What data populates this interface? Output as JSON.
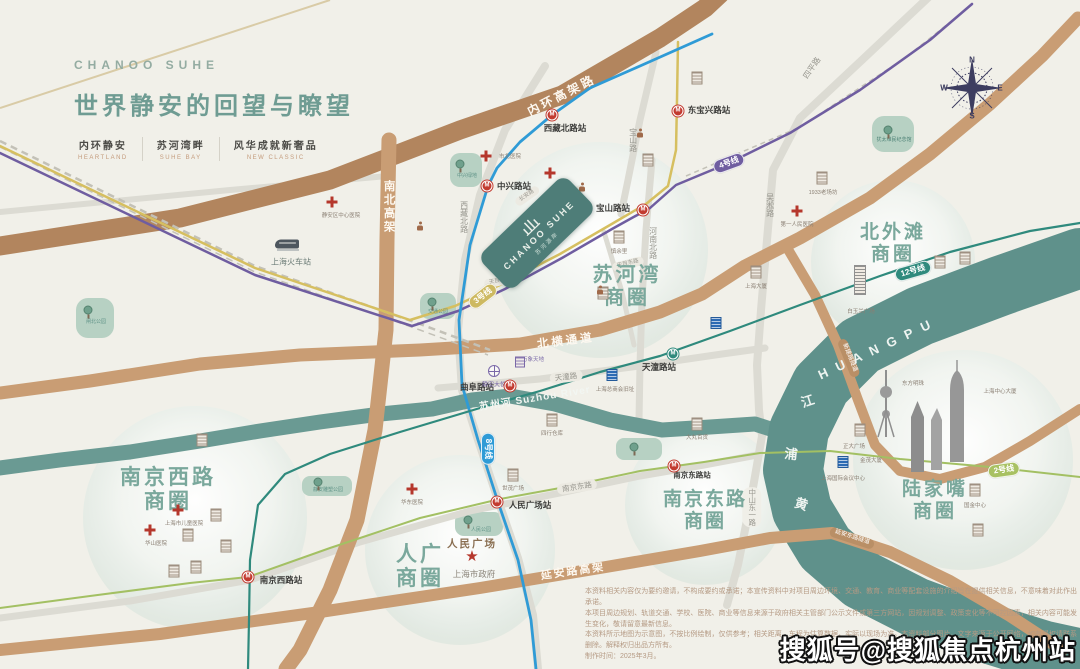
{
  "header": {
    "brand": "CHANOO SUHE",
    "title": "世界静安的回望与瞭望",
    "taglines": [
      {
        "zh": "内环静安",
        "en": "HEARTLAND"
      },
      {
        "zh": "苏河湾畔",
        "en": "SUHE BAY"
      },
      {
        "zh": "风华成就新奢品",
        "en": "NEW CLASSIC"
      }
    ]
  },
  "project": {
    "logo_en": "CHANOO SUHE",
    "logo_zh": "苏河源岸"
  },
  "watermark": "搜狐号@搜狐焦点杭州站",
  "disclaimer": {
    "lines": [
      "本资料相关内容仅为要约邀请，不构成要约或承诺；本宣传资料中对项目周边环境、交通、教育、商业等配套设施的介绍旨在提供相关信息，不意味着对此作出承诺。",
      "本项目周边规划、轨道交通、学校、医院、商业等信息来源于政府相关主管部门公示文件或第三方网站，因规划调整、政策变化等不可控因素，相关内容可能发生变化，敬请留意最新信息。",
      "本资料所示地图为示意图，不按比例绘制，仅供参考；相关距离、车程为估算数据，实际以现场为准。本资料部分图片、文字来源于公开网络，如有侵权请联系删除。解释权归出品方所有。",
      "制作时间：2025年3月。"
    ]
  },
  "map": {
    "labels": [
      {
        "t": "内环高架路",
        "x": 562,
        "y": 96,
        "fs": 12,
        "c": "#fdf8f0",
        "b": 1,
        "r": -27,
        "ls": 3,
        "cls": "road-name"
      },
      {
        "t": "南北高架",
        "x": 388,
        "y": 207,
        "fs": 11.5,
        "c": "#fdf8f0",
        "b": 1,
        "v": 1,
        "ls": 2,
        "cls": "road-name"
      },
      {
        "t": "北横通道",
        "x": 566,
        "y": 342,
        "fs": 11.5,
        "c": "#fdf8f0",
        "b": 1,
        "r": -7,
        "ls": 3,
        "cls": "road-name"
      },
      {
        "t": "延安路高架",
        "x": 573,
        "y": 572,
        "fs": 11,
        "c": "#fdf8f0",
        "b": 1,
        "r": -8,
        "ls": 2,
        "cls": "road-name"
      },
      {
        "t": "延安东路隧道",
        "x": 852,
        "y": 538,
        "fs": 6,
        "c": "#ffffff",
        "r": 18,
        "bg": "#b98f66",
        "cls": "tunnel-name"
      },
      {
        "t": "新建路隧道",
        "x": 849,
        "y": 358,
        "fs": 6,
        "c": "#ffffff",
        "r": 68,
        "bg": "#b98f66",
        "cls": "tunnel-name"
      },
      {
        "t": "四平路",
        "x": 812,
        "y": 68,
        "fs": 8,
        "c": "#97968e",
        "r": -55,
        "cls": "street-name"
      },
      {
        "t": "吴淞路",
        "x": 770,
        "y": 205,
        "fs": 8,
        "c": "#97968e",
        "v": 1,
        "cls": "street-name"
      },
      {
        "t": "宝山路",
        "x": 633,
        "y": 140,
        "fs": 8,
        "c": "#97968e",
        "v": 1,
        "cls": "street-name"
      },
      {
        "t": "西藏北路",
        "x": 464,
        "y": 217,
        "fs": 8,
        "c": "#97968e",
        "v": 1,
        "cls": "street-name"
      },
      {
        "t": "河南北路",
        "x": 653,
        "y": 243,
        "fs": 8,
        "c": "#97968e",
        "v": 1,
        "cls": "street-name"
      },
      {
        "t": "中山东一路",
        "x": 752,
        "y": 507,
        "fs": 7.5,
        "c": "#97968e",
        "v": 1,
        "bg": "#f0efe8",
        "cls": "street-name"
      },
      {
        "t": "天潼路",
        "x": 566,
        "y": 377,
        "fs": 7.5,
        "c": "#97968e",
        "r": -7,
        "bg": "#eceae2",
        "cls": "street-name"
      },
      {
        "t": "南京东路",
        "x": 577,
        "y": 487,
        "fs": 7.5,
        "c": "#97968e",
        "r": -9,
        "bg": "#eceae2",
        "cls": "street-name"
      },
      {
        "t": "长安路",
        "x": 527,
        "y": 196,
        "fs": 5.5,
        "c": "#9b9a92",
        "r": -35,
        "bg": "#eceae2",
        "cls": "street-name"
      },
      {
        "t": "公兴路",
        "x": 572,
        "y": 195,
        "fs": 5.5,
        "c": "#9b9a92",
        "r": -35,
        "bg": "#eceae2",
        "cls": "street-name"
      },
      {
        "t": "天目中路",
        "x": 500,
        "y": 281,
        "fs": 5.5,
        "c": "#9b9a92",
        "r": -12,
        "bg": "#eceae2",
        "cls": "street-name"
      },
      {
        "t": "天目东路",
        "x": 628,
        "y": 264,
        "fs": 5.5,
        "c": "#9b9a92",
        "r": -14,
        "bg": "#eceae2",
        "cls": "street-name"
      },
      {
        "t": "3号线",
        "x": 483,
        "y": 296,
        "fs": 8,
        "c": "#ffffff",
        "b": 1,
        "r": -38,
        "bg": "#cdb961",
        "cls": "metro-badge"
      },
      {
        "t": "4号线",
        "x": 729,
        "y": 163,
        "fs": 8,
        "c": "#ffffff",
        "b": 1,
        "r": -20,
        "bg": "#6f5da0",
        "cls": "metro-badge"
      },
      {
        "t": "8号线",
        "x": 488,
        "y": 449,
        "fs": 8,
        "c": "#ffffff",
        "b": 1,
        "r": 90,
        "bg": "#2f9bd6",
        "cls": "metro-badge"
      },
      {
        "t": "12号线",
        "x": 913,
        "y": 271,
        "fs": 8,
        "c": "#ffffff",
        "b": 1,
        "r": -16,
        "bg": "#2f8a7d",
        "cls": "metro-badge"
      },
      {
        "t": "2号线",
        "x": 1004,
        "y": 470,
        "fs": 8,
        "c": "#ffffff",
        "b": 1,
        "r": -8,
        "bg": "#a8c162",
        "cls": "metro-badge"
      },
      {
        "t": "中兴路站",
        "x": 514,
        "y": 187,
        "fs": 8.5,
        "c": "#3c3c3a",
        "b": 1,
        "cls": "station-name"
      },
      {
        "t": "西藏北路站",
        "x": 565,
        "y": 129,
        "fs": 8.5,
        "c": "#3c3c3a",
        "b": 1,
        "cls": "station-name"
      },
      {
        "t": "东宝兴路站",
        "x": 709,
        "y": 111,
        "fs": 8.5,
        "c": "#3c3c3a",
        "b": 1,
        "cls": "station-name"
      },
      {
        "t": "宝山路站",
        "x": 613,
        "y": 209,
        "fs": 8.5,
        "c": "#3c3c3a",
        "b": 1,
        "cls": "station-name"
      },
      {
        "t": "天潼路站",
        "x": 659,
        "y": 368,
        "fs": 8.5,
        "c": "#3c3c3a",
        "b": 1,
        "cls": "station-name"
      },
      {
        "t": "曲阜路站",
        "x": 477,
        "y": 388,
        "fs": 8.5,
        "c": "#3c3c3a",
        "b": 1,
        "cls": "station-name"
      },
      {
        "t": "人民广场站",
        "x": 530,
        "y": 506,
        "fs": 8.5,
        "c": "#3c3c3a",
        "b": 1,
        "cls": "station-name"
      },
      {
        "t": "南京东路站",
        "x": 692,
        "y": 476,
        "fs": 7.5,
        "c": "#3c3c3a",
        "b": 1,
        "cls": "station-name"
      },
      {
        "t": "南京西路站",
        "x": 281,
        "y": 581,
        "fs": 8.5,
        "c": "#3c3c3a",
        "b": 1,
        "cls": "station-name"
      },
      {
        "t": "苏河湾\n商圈",
        "x": 627,
        "y": 287,
        "fs": 20,
        "c": "#7aa89c",
        "b": 1,
        "ls": 3,
        "cls": "district-name"
      },
      {
        "t": "北外滩\n商圈",
        "x": 893,
        "y": 244,
        "fs": 19,
        "c": "#7aa89c",
        "b": 1,
        "ls": 3,
        "cls": "district-name"
      },
      {
        "t": "南京西路\n商圈",
        "x": 168,
        "y": 490,
        "fs": 21,
        "c": "#7aa89c",
        "b": 1,
        "ls": 3,
        "cls": "district-name"
      },
      {
        "t": "人广\n商圈",
        "x": 420,
        "y": 567,
        "fs": 21,
        "c": "#7aa89c",
        "b": 1,
        "ls": 3,
        "cls": "district-name"
      },
      {
        "t": "南京东路\n商圈",
        "x": 705,
        "y": 511,
        "fs": 19,
        "c": "#7aa89c",
        "b": 1,
        "ls": 2,
        "cls": "district-name"
      },
      {
        "t": "陆家嘴\n商圈",
        "x": 935,
        "y": 501,
        "fs": 19,
        "c": "#7aa89c",
        "b": 1,
        "ls": 3,
        "cls": "district-name"
      },
      {
        "t": "苏州河 Suzhou River",
        "x": 535,
        "y": 399,
        "fs": 10,
        "c": "#f2f6f2",
        "b": 1,
        "r": -9,
        "ls": 1,
        "cls": "river-name"
      },
      {
        "t": "H U A N G   P U",
        "x": 876,
        "y": 350,
        "fs": 13,
        "c": "#eef4f1",
        "b": 1,
        "r": -25,
        "ls": 3,
        "cls": "river-name"
      },
      {
        "t": "江",
        "x": 808,
        "y": 402,
        "fs": 13,
        "c": "#eef4f1",
        "b": 1,
        "r": -18,
        "cls": "river-name"
      },
      {
        "t": "浦",
        "x": 791,
        "y": 455,
        "fs": 13,
        "c": "#eef4f1",
        "b": 1,
        "r": 6,
        "cls": "river-name"
      },
      {
        "t": "黄",
        "x": 801,
        "y": 505,
        "fs": 13,
        "c": "#eef4f1",
        "b": 1,
        "r": 18,
        "cls": "river-name"
      },
      {
        "t": "白玉兰广场",
        "x": 861,
        "y": 312,
        "fs": 5.5,
        "cls": "poi-name"
      },
      {
        "t": "1933老场坊",
        "x": 823,
        "y": 193,
        "fs": 5.5,
        "cls": "poi-name"
      },
      {
        "t": "上海大厦",
        "x": 756,
        "y": 287,
        "fs": 5.5,
        "cls": "poi-name"
      },
      {
        "t": "大丸百货",
        "x": 697,
        "y": 438,
        "fs": 5.5,
        "cls": "poi-name"
      },
      {
        "t": "世茂广场",
        "x": 513,
        "y": 489,
        "fs": 5.5,
        "cls": "poi-name"
      },
      {
        "t": "四行仓库",
        "x": 552,
        "y": 434,
        "fs": 5.5,
        "cls": "poi-name"
      },
      {
        "t": "上海总商会旧址",
        "x": 615,
        "y": 390,
        "fs": 5.5,
        "cls": "poi-name"
      },
      {
        "t": "慎余里",
        "x": 619,
        "y": 252,
        "fs": 5.5,
        "cls": "poi-name"
      },
      {
        "t": "正大广场",
        "x": 854,
        "y": 447,
        "fs": 5.5,
        "cls": "poi-name"
      },
      {
        "t": "国金中心",
        "x": 975,
        "y": 506,
        "fs": 5.5,
        "cls": "poi-name"
      },
      {
        "t": "东方明珠",
        "x": 913,
        "y": 384,
        "fs": 5.5,
        "cls": "poi-name"
      },
      {
        "t": "金茂大厦",
        "x": 871,
        "y": 461,
        "fs": 5.5,
        "cls": "poi-name"
      },
      {
        "t": "上海中心大厦",
        "x": 1000,
        "y": 392,
        "fs": 5.5,
        "cls": "poi-name"
      },
      {
        "t": "上海国际会议中心",
        "x": 843,
        "y": 479,
        "fs": 5.5,
        "cls": "poi-name"
      },
      {
        "t": "静安大悦城",
        "x": 497,
        "y": 386,
        "fs": 6,
        "c": "#7a68a8",
        "cls": "poi-name"
      },
      {
        "t": "万象天地",
        "x": 533,
        "y": 360,
        "fs": 5.5,
        "c": "#7a68a8",
        "cls": "poi-name"
      },
      {
        "t": "静安区中心医院",
        "x": 341,
        "y": 216,
        "fs": 5.5,
        "cls": "poi-name"
      },
      {
        "t": "华东医院",
        "x": 412,
        "y": 503,
        "fs": 5.5,
        "cls": "poi-name"
      },
      {
        "t": "上海市儿童医院",
        "x": 184,
        "y": 524,
        "fs": 5.5,
        "cls": "poi-name"
      },
      {
        "t": "华山医院",
        "x": 156,
        "y": 544,
        "fs": 5.5,
        "cls": "poi-name"
      },
      {
        "t": "第一人民医院",
        "x": 797,
        "y": 225,
        "fs": 5.5,
        "cls": "poi-name"
      },
      {
        "t": "市北医院",
        "x": 510,
        "y": 157,
        "fs": 5.5,
        "cls": "poi-name"
      },
      {
        "t": "人民广场",
        "x": 472,
        "y": 544,
        "fs": 10.5,
        "c": "#8a6f52",
        "b": 1,
        "ls": 2,
        "cls": "poi-name"
      },
      {
        "t": "上海市政府",
        "x": 474,
        "y": 575,
        "fs": 8.5,
        "c": "#8b857a",
        "cls": "poi-name"
      },
      {
        "t": "上海火车站",
        "x": 291,
        "y": 262,
        "fs": 8,
        "c": "#6d7d78",
        "cls": "poi-name"
      },
      {
        "t": "中兴绿地",
        "x": 467,
        "y": 177,
        "fs": 5,
        "c": "#5f9387",
        "cls": "park-name"
      },
      {
        "t": "闸北公园",
        "x": 96,
        "y": 323,
        "fs": 5,
        "c": "#5f9387",
        "cls": "park-name"
      },
      {
        "t": "交通公园",
        "x": 438,
        "y": 313,
        "fs": 5,
        "c": "#5f9387",
        "cls": "park-name"
      },
      {
        "t": "犹太难民纪念馆",
        "x": 894,
        "y": 141,
        "fs": 5,
        "c": "#4f8377",
        "cls": "park-name"
      },
      {
        "t": "静安雕塑公园",
        "x": 328,
        "y": 491,
        "fs": 5,
        "c": "#5f9387",
        "cls": "park-name"
      },
      {
        "t": "人民公园",
        "x": 481,
        "y": 531,
        "fs": 5,
        "c": "#5f9387",
        "cls": "park-name"
      },
      {
        "t": "N",
        "x": 972,
        "y": 60,
        "fs": 8,
        "c": "#3d3d60",
        "b": 1,
        "cls": "compass-letter"
      },
      {
        "t": "E",
        "x": 1000,
        "y": 88,
        "fs": 8,
        "c": "#3d3d60",
        "b": 1,
        "cls": "compass-letter"
      },
      {
        "t": "S",
        "x": 972,
        "y": 116,
        "fs": 8,
        "c": "#3d3d60",
        "b": 1,
        "cls": "compass-letter"
      },
      {
        "t": "W",
        "x": 944,
        "y": 88,
        "fs": 8,
        "c": "#3d3d60",
        "b": 1,
        "cls": "compass-letter"
      }
    ],
    "icons": [
      {
        "k": "m",
        "x": 487,
        "y": 186
      },
      {
        "k": "m",
        "x": 552,
        "y": 115
      },
      {
        "k": "m",
        "x": 678,
        "y": 111
      },
      {
        "k": "m",
        "x": 643,
        "y": 210
      },
      {
        "k": "m",
        "x": 510,
        "y": 386
      },
      {
        "k": "m",
        "x": 497,
        "y": 502
      },
      {
        "k": "m",
        "x": 674,
        "y": 466
      },
      {
        "k": "m",
        "x": 248,
        "y": 577
      },
      {
        "k": "mt",
        "x": 673,
        "y": 354
      },
      {
        "k": "b",
        "x": 860,
        "y": 430
      },
      {
        "k": "b",
        "x": 822,
        "y": 178
      },
      {
        "k": "b",
        "x": 756,
        "y": 272
      },
      {
        "k": "b",
        "x": 697,
        "y": 424
      },
      {
        "k": "b",
        "x": 513,
        "y": 475
      },
      {
        "k": "b",
        "x": 552,
        "y": 420
      },
      {
        "k": "b",
        "x": 619,
        "y": 237
      },
      {
        "k": "b",
        "x": 975,
        "y": 490
      },
      {
        "k": "b",
        "x": 940,
        "y": 262
      },
      {
        "k": "b",
        "x": 965,
        "y": 258
      },
      {
        "k": "b",
        "x": 697,
        "y": 78
      },
      {
        "k": "b",
        "x": 202,
        "y": 440
      },
      {
        "k": "b",
        "x": 216,
        "y": 515
      },
      {
        "k": "b",
        "x": 188,
        "y": 535
      },
      {
        "k": "b",
        "x": 226,
        "y": 546
      },
      {
        "k": "b",
        "x": 196,
        "y": 567
      },
      {
        "k": "b",
        "x": 174,
        "y": 571
      },
      {
        "k": "b",
        "x": 648,
        "y": 160
      },
      {
        "k": "b",
        "x": 603,
        "y": 293
      },
      {
        "k": "b",
        "x": 978,
        "y": 530
      },
      {
        "k": "bt",
        "x": 860,
        "y": 280
      },
      {
        "k": "bb",
        "x": 716,
        "y": 323
      },
      {
        "k": "bb",
        "x": 612,
        "y": 375
      },
      {
        "k": "bb",
        "x": 843,
        "y": 462
      },
      {
        "k": "pb",
        "x": 520,
        "y": 362
      },
      {
        "k": "x",
        "x": 550,
        "y": 173
      },
      {
        "k": "x",
        "x": 332,
        "y": 202
      },
      {
        "k": "x",
        "x": 412,
        "y": 489
      },
      {
        "k": "x",
        "x": 178,
        "y": 510
      },
      {
        "k": "x",
        "x": 150,
        "y": 530
      },
      {
        "k": "x",
        "x": 797,
        "y": 211
      },
      {
        "k": "x",
        "x": 486,
        "y": 156
      },
      {
        "k": "t",
        "x": 460,
        "y": 164
      },
      {
        "k": "t",
        "x": 88,
        "y": 310
      },
      {
        "k": "t",
        "x": 432,
        "y": 302
      },
      {
        "k": "t",
        "x": 888,
        "y": 130
      },
      {
        "k": "t",
        "x": 318,
        "y": 482
      },
      {
        "k": "t",
        "x": 468,
        "y": 520
      },
      {
        "k": "t",
        "x": 634,
        "y": 447
      },
      {
        "k": "s",
        "x": 472,
        "y": 557
      },
      {
        "k": "w",
        "x": 494,
        "y": 371
      },
      {
        "k": "p",
        "x": 420,
        "y": 226
      },
      {
        "k": "p",
        "x": 582,
        "y": 187
      },
      {
        "k": "p",
        "x": 600,
        "y": 290
      },
      {
        "k": "p",
        "x": 640,
        "y": 133
      },
      {
        "k": "tr",
        "x": 287,
        "y": 244
      }
    ]
  }
}
